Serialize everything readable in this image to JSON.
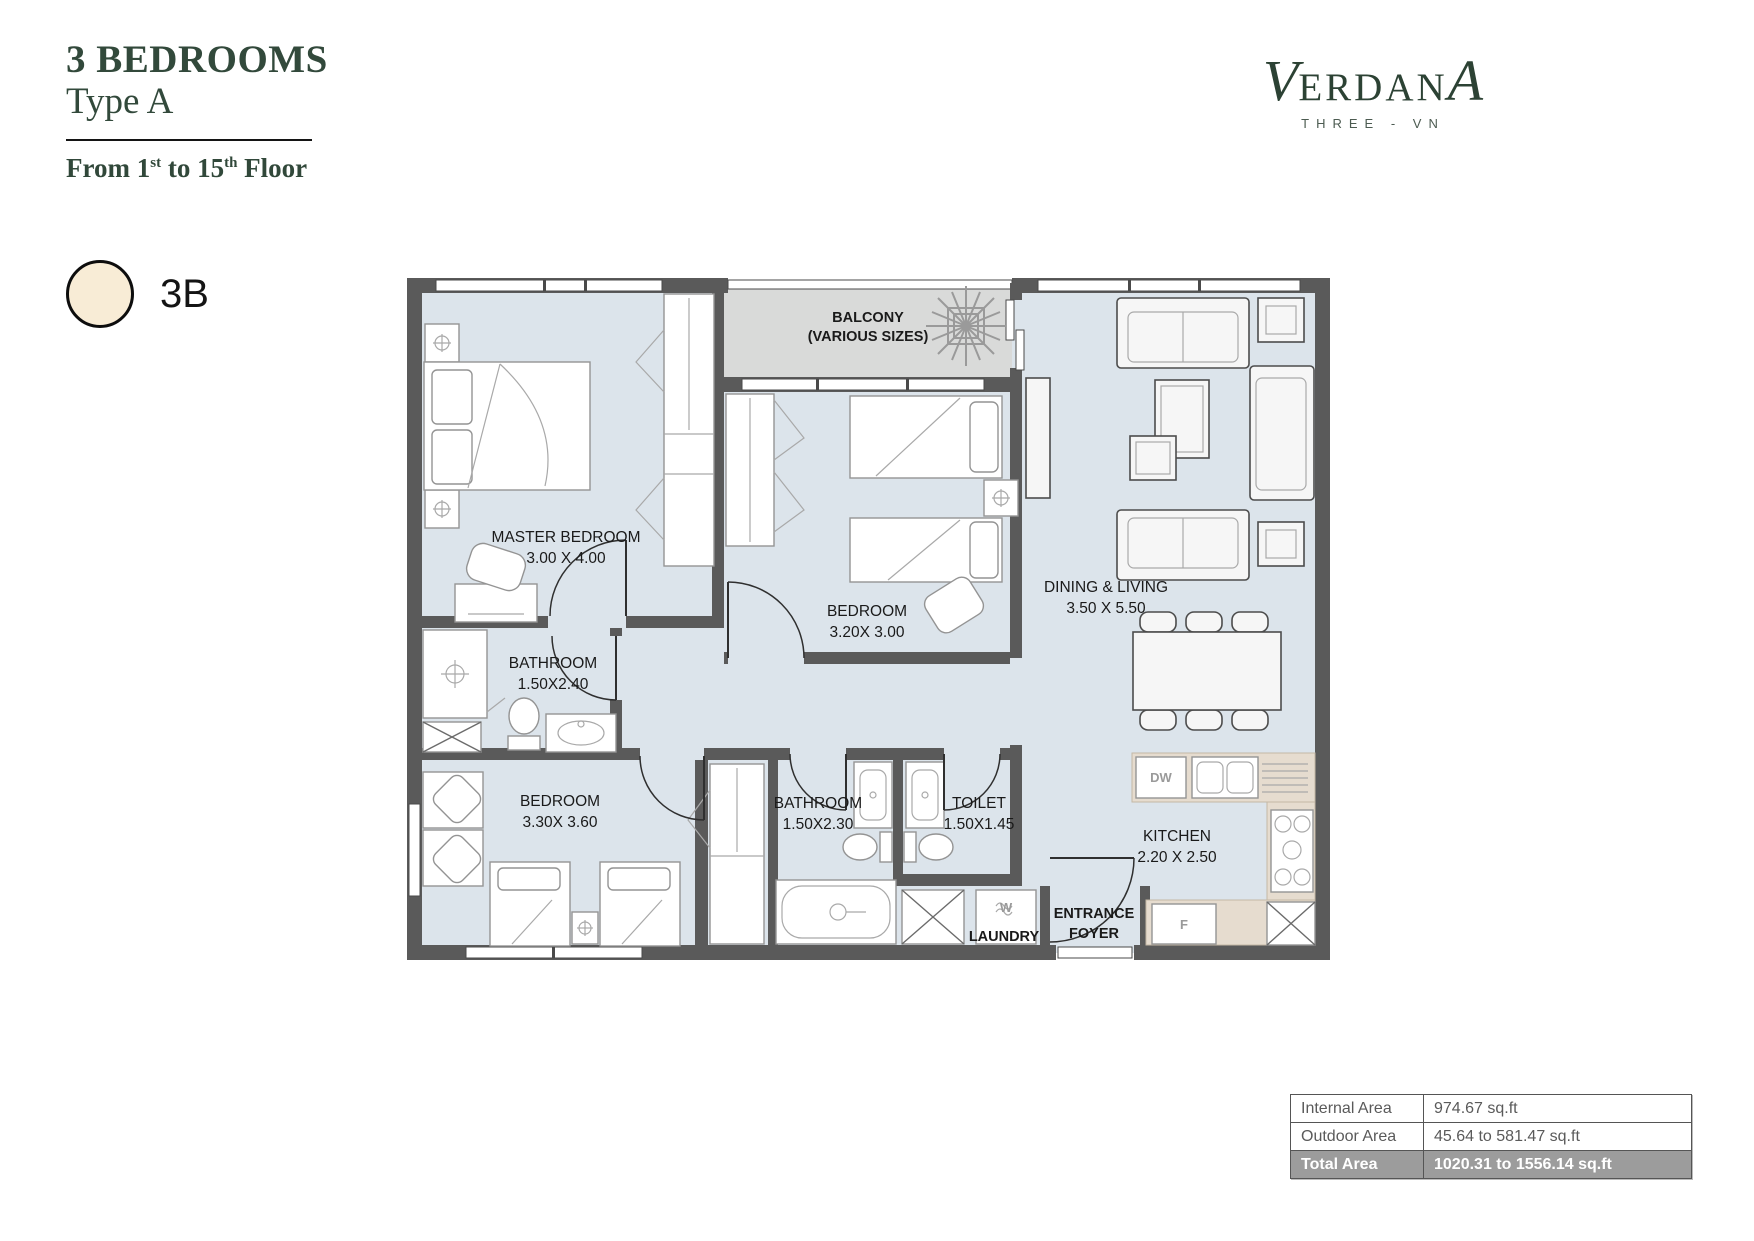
{
  "header": {
    "title_line1": "3 BEDROOMS",
    "title_line2": "Type A",
    "floor": {
      "p1": "From 1",
      "sup1": "st",
      "p2": " to 15",
      "sup2": "th",
      "p3": " Floor"
    }
  },
  "logo": {
    "first": "V",
    "mid": "ERDAN",
    "last": "A",
    "sub": "THREE - VN"
  },
  "unit_badge": {
    "label": "3B",
    "fill": "#f8ecd6"
  },
  "floorplan": {
    "colors": {
      "floor": "#dce4eb",
      "balcony_floor": "#d9dad9",
      "wall": "#5a5a5a",
      "counter": "#e6dccf",
      "accent_green": "#32493b"
    },
    "rooms": [
      {
        "id": "master-bedroom",
        "name": "MASTER BEDROOM",
        "dims": "3.00 X 4.00"
      },
      {
        "id": "balcony",
        "name": "BALCONY",
        "dims": "(VARIOUS SIZES)"
      },
      {
        "id": "bedroom-2",
        "name": "BEDROOM",
        "dims": "3.20X 3.00"
      },
      {
        "id": "dining-living",
        "name": "DINING & LIVING",
        "dims": "3.50 X 5.50"
      },
      {
        "id": "bathroom-1",
        "name": "BATHROOM",
        "dims": "1.50X2.40"
      },
      {
        "id": "bedroom-3",
        "name": "BEDROOM",
        "dims": "3.30X 3.60"
      },
      {
        "id": "bathroom-2",
        "name": "BATHROOM",
        "dims": "1.50X2.30"
      },
      {
        "id": "toilet",
        "name": "TOILET",
        "dims": "1.50X1.45"
      },
      {
        "id": "kitchen",
        "name": "KITCHEN",
        "dims": "2.20 X 2.50"
      },
      {
        "id": "entrance-foyer",
        "name": "ENTRANCE",
        "dims": "FOYER"
      },
      {
        "id": "laundry",
        "name": "LAUNDRY",
        "dims": ""
      }
    ],
    "appliances": {
      "dishwasher": "DW",
      "fridge": "F",
      "washer": "W"
    }
  },
  "area_table": {
    "rows": [
      {
        "label": "Internal Area",
        "value": "974.67 sq.ft",
        "highlight": false
      },
      {
        "label": "Outdoor Area",
        "value": "45.64 to 581.47 sq.ft",
        "highlight": false
      },
      {
        "label": "Total Area",
        "value": "1020.31 to 1556.14 sq.ft",
        "highlight": true
      }
    ]
  }
}
